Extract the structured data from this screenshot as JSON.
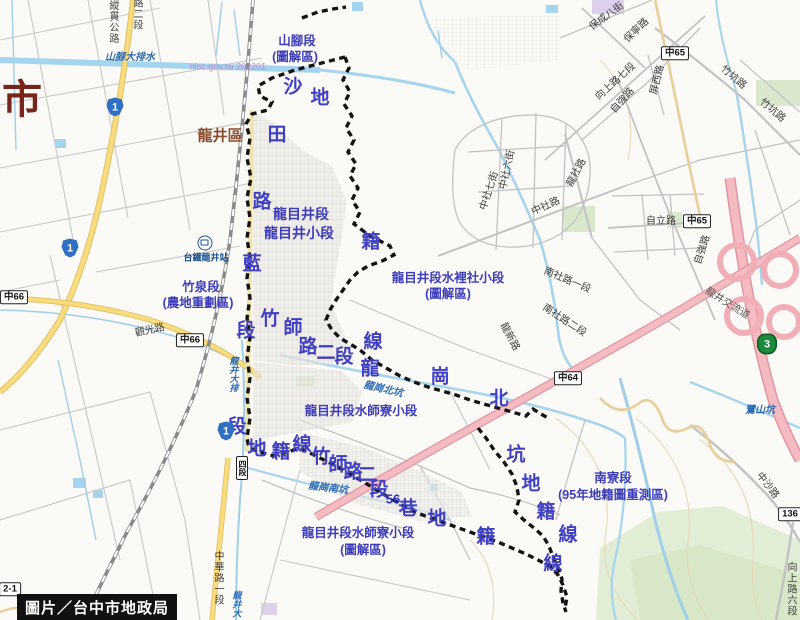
{
  "credit": "圖片／台中市地政局",
  "city_partial": "市",
  "district": "龍井區",
  "colors": {
    "boundary": "#141414",
    "water": "#a5d5ee",
    "road_yellow": "#f8dc7e",
    "road_pink": "#f2b4ba",
    "label_blue": "#4040c4",
    "district_brown": "#8a4a2e",
    "city_red": "#77241a",
    "green_area": "#d9e8cc"
  },
  "labels": [
    {
      "t": "市",
      "x": 22,
      "y": 100,
      "c": "c-city",
      "n": "city-label-partial"
    },
    {
      "t": "龍井區",
      "x": 220,
      "y": 136,
      "c": "c-district",
      "n": "district-label"
    },
    {
      "t": "山腳段",
      "x": 297,
      "y": 41,
      "c": "c-area",
      "n": "section-shanjiao"
    },
    {
      "t": "(圖解區)",
      "x": 295,
      "y": 57,
      "c": "c-area",
      "n": "section-shanjiao-note"
    },
    {
      "t": "龍目井段",
      "x": 301,
      "y": 214,
      "c": "c-arealg",
      "n": "section-longmujing"
    },
    {
      "t": "龍目井小段",
      "x": 299,
      "y": 233,
      "c": "c-arealg",
      "n": "section-longmujing-sub"
    },
    {
      "t": "竹泉段",
      "x": 201,
      "y": 287,
      "c": "c-area",
      "n": "section-zhuquan"
    },
    {
      "t": "(農地重劃區)",
      "x": 198,
      "y": 303,
      "c": "c-area",
      "n": "section-zhuquan-note"
    },
    {
      "t": "龍目井段水裡社小段",
      "x": 448,
      "y": 278,
      "c": "c-area",
      "n": "section-shuilishe"
    },
    {
      "t": "(圖解區)",
      "x": 448,
      "y": 294,
      "c": "c-area",
      "n": "section-shuilishe-note"
    },
    {
      "t": "龍目井段水師寮小段",
      "x": 361,
      "y": 411,
      "c": "c-area",
      "n": "section-shuishiliao"
    },
    {
      "t": "南寮段",
      "x": 613,
      "y": 478,
      "c": "c-area",
      "n": "section-nanliao"
    },
    {
      "t": "(95年地籍圖重測區)",
      "x": 613,
      "y": 495,
      "c": "c-area",
      "n": "section-nanliao-note"
    },
    {
      "t": "龍目井段水師寮小段",
      "x": 358,
      "y": 533,
      "c": "c-area",
      "n": "section-shuishiliao2"
    },
    {
      "t": "(圖解區)",
      "x": 363,
      "y": 550,
      "c": "c-area",
      "n": "section-shuishiliao2-note"
    },
    {
      "t": "沙",
      "x": 293,
      "y": 87,
      "c": "c-big"
    },
    {
      "t": "地",
      "x": 320,
      "y": 98,
      "c": "c-big"
    },
    {
      "t": "田",
      "x": 277,
      "y": 135,
      "c": "c-big"
    },
    {
      "t": "路",
      "x": 262,
      "y": 202,
      "c": "c-big"
    },
    {
      "t": "籍",
      "x": 371,
      "y": 242,
      "c": "c-big"
    },
    {
      "t": "藍",
      "x": 252,
      "y": 264,
      "c": "c-big"
    },
    {
      "t": "竹",
      "x": 270,
      "y": 319,
      "c": "c-big"
    },
    {
      "t": "師",
      "x": 293,
      "y": 328,
      "c": "c-big"
    },
    {
      "t": "段",
      "x": 246,
      "y": 331,
      "c": "c-big"
    },
    {
      "t": "線",
      "x": 373,
      "y": 342,
      "c": "c-big"
    },
    {
      "t": "路",
      "x": 308,
      "y": 347,
      "c": "c-big"
    },
    {
      "t": "二",
      "x": 326,
      "y": 353,
      "c": "c-big"
    },
    {
      "t": "段",
      "x": 344,
      "y": 357,
      "c": "c-big"
    },
    {
      "t": "龍",
      "x": 370,
      "y": 369,
      "c": "c-big"
    },
    {
      "t": "崗",
      "x": 440,
      "y": 377,
      "c": "c-big"
    },
    {
      "t": "北",
      "x": 499,
      "y": 399,
      "c": "c-big"
    },
    {
      "t": "段",
      "x": 237,
      "y": 427,
      "c": "c-big"
    },
    {
      "t": "地",
      "x": 257,
      "y": 449,
      "c": "c-big"
    },
    {
      "t": "籍",
      "x": 281,
      "y": 452,
      "c": "c-big"
    },
    {
      "t": "線",
      "x": 302,
      "y": 445,
      "c": "c-big"
    },
    {
      "t": "竹",
      "x": 321,
      "y": 457,
      "c": "c-big"
    },
    {
      "t": "師",
      "x": 338,
      "y": 465,
      "c": "c-big"
    },
    {
      "t": "路",
      "x": 353,
      "y": 472,
      "c": "c-big"
    },
    {
      "t": "二",
      "x": 367,
      "y": 475,
      "c": "c-big"
    },
    {
      "t": "段",
      "x": 379,
      "y": 490,
      "c": "c-big"
    },
    {
      "t": "56",
      "x": 393,
      "y": 499,
      "c": "c-big56"
    },
    {
      "t": "巷",
      "x": 408,
      "y": 509,
      "c": "c-big"
    },
    {
      "t": "坑",
      "x": 516,
      "y": 455,
      "c": "c-big"
    },
    {
      "t": "地",
      "x": 531,
      "y": 484,
      "c": "c-big"
    },
    {
      "t": "籍",
      "x": 546,
      "y": 512,
      "c": "c-big"
    },
    {
      "t": "線",
      "x": 568,
      "y": 535,
      "c": "c-big"
    },
    {
      "t": "地",
      "x": 437,
      "y": 519,
      "c": "c-big"
    },
    {
      "t": "籍",
      "x": 486,
      "y": 537,
      "c": "c-big"
    },
    {
      "t": "線",
      "x": 553,
      "y": 564,
      "c": "c-big"
    },
    {
      "t": "山腳大排水",
      "x": 130,
      "y": 58,
      "c": "c-stream",
      "n": "stream-shanjiao-drain"
    },
    {
      "t": "nlsc.gov.tw 202201",
      "x": 228,
      "y": 67,
      "c": "c-wm",
      "n": "nlsc-watermark"
    },
    {
      "t": "龍崗北坑",
      "x": 383,
      "y": 390,
      "c": "c-stream",
      "r": 13,
      "n": "stream-longgang-north"
    },
    {
      "t": "龍崗南坑",
      "x": 328,
      "y": 489,
      "c": "c-stream",
      "r": 7,
      "n": "stream-longgang-south"
    },
    {
      "t": "鷺山坑",
      "x": 760,
      "y": 411,
      "c": "c-stream",
      "n": "stream-lushan"
    },
    {
      "t": "龍井大排",
      "x": 233,
      "y": 374,
      "c": "c-streamv",
      "n": "stream-longjing-drain"
    },
    {
      "t": "龍井大",
      "x": 236,
      "y": 604,
      "c": "c-streamv",
      "n": "stream-longjing-drain2"
    },
    {
      "t": "台鐵龍井站",
      "x": 206,
      "y": 258,
      "c": "c-station",
      "n": "station-longjing"
    },
    {
      "t": "縱貫公路",
      "x": 112,
      "y": 22,
      "c": "c-roadv",
      "n": "road-zongguan"
    },
    {
      "t": "路二段",
      "x": 136,
      "y": 14,
      "c": "c-roadv",
      "n": "road-top-partial"
    },
    {
      "t": "觀光路",
      "x": 150,
      "y": 331,
      "c": "c-road",
      "r": -12,
      "n": "road-guanguang"
    },
    {
      "t": "中華路一段",
      "x": 217,
      "y": 578,
      "c": "c-roadv",
      "n": "road-zhonghua"
    },
    {
      "t": "保成八街",
      "x": 607,
      "y": 17,
      "c": "c-road",
      "r": -36,
      "n": "road-baocheng"
    },
    {
      "t": "保寧路",
      "x": 637,
      "y": 31,
      "c": "c-road",
      "r": -44,
      "n": "road-baoning"
    },
    {
      "t": "向上路七段",
      "x": 616,
      "y": 82,
      "c": "c-road",
      "r": -42,
      "n": "road-xiangshang7"
    },
    {
      "t": "屏西路",
      "x": 658,
      "y": 80,
      "c": "c-road",
      "r": -76,
      "n": "road-pingxi"
    },
    {
      "t": "自強路",
      "x": 623,
      "y": 101,
      "c": "c-road",
      "r": -48,
      "n": "road-ziqiang1"
    },
    {
      "t": "自強路",
      "x": 703,
      "y": 250,
      "c": "c-road",
      "r": -72,
      "n": "road-ziqiang2"
    },
    {
      "t": "自立路",
      "x": 661,
      "y": 222,
      "c": "c-road",
      "n": "road-zili"
    },
    {
      "t": "中社六街",
      "x": 508,
      "y": 170,
      "c": "c-road",
      "r": -78,
      "n": "road-zhongshe6"
    },
    {
      "t": "中社七街",
      "x": 490,
      "y": 191,
      "c": "c-road",
      "r": -72,
      "n": "road-zhongshe7"
    },
    {
      "t": "中社路",
      "x": 546,
      "y": 207,
      "c": "c-road",
      "r": -24,
      "n": "road-zhongshe"
    },
    {
      "t": "龍社路",
      "x": 577,
      "y": 173,
      "c": "c-road",
      "r": -62,
      "n": "road-longshe"
    },
    {
      "t": "竹坑路",
      "x": 733,
      "y": 78,
      "c": "c-road",
      "r": 40,
      "n": "road-zhukeng1"
    },
    {
      "t": "竹坑路",
      "x": 772,
      "y": 111,
      "c": "c-road",
      "r": 40,
      "n": "road-zhukeng2"
    },
    {
      "t": "龍新路",
      "x": 509,
      "y": 337,
      "c": "c-road",
      "r": 62,
      "n": "road-longxin"
    },
    {
      "t": "南社路一段",
      "x": 567,
      "y": 281,
      "c": "c-road",
      "r": 23,
      "n": "road-nanshe1"
    },
    {
      "t": "南社路二段",
      "x": 564,
      "y": 321,
      "c": "c-road",
      "r": 33,
      "n": "road-nanshe2"
    },
    {
      "t": "龍井交流道",
      "x": 727,
      "y": 304,
      "c": "c-roadp",
      "r": 32,
      "n": "label-longjing-interchange"
    },
    {
      "t": "中沙路",
      "x": 767,
      "y": 486,
      "c": "c-road",
      "r": 52,
      "n": "road-zhongsha"
    },
    {
      "t": "向上路六段",
      "x": 790,
      "y": 589,
      "c": "c-roadv",
      "n": "road-xiangshang6"
    }
  ],
  "badges": [
    {
      "t": "中65",
      "x": 675,
      "y": 53
    },
    {
      "t": "中65",
      "x": 697,
      "y": 221
    },
    {
      "t": "中66",
      "x": 14,
      "y": 297
    },
    {
      "t": "中66",
      "x": 190,
      "y": 340
    },
    {
      "t": "中64",
      "x": 568,
      "y": 378
    },
    {
      "t": "136",
      "x": 790,
      "y": 514
    },
    {
      "t": "2-1",
      "x": 10,
      "y": 589
    },
    {
      "t": "四段",
      "x": 242,
      "y": 468,
      "v": true
    }
  ],
  "shields": [
    {
      "t": "1",
      "x": 115,
      "y": 107,
      "k": "prov"
    },
    {
      "t": "1",
      "x": 70,
      "y": 248,
      "k": "prov"
    },
    {
      "t": "1",
      "x": 226,
      "y": 431,
      "k": "prov"
    },
    {
      "t": "3",
      "x": 767,
      "y": 344,
      "k": "nat"
    }
  ]
}
